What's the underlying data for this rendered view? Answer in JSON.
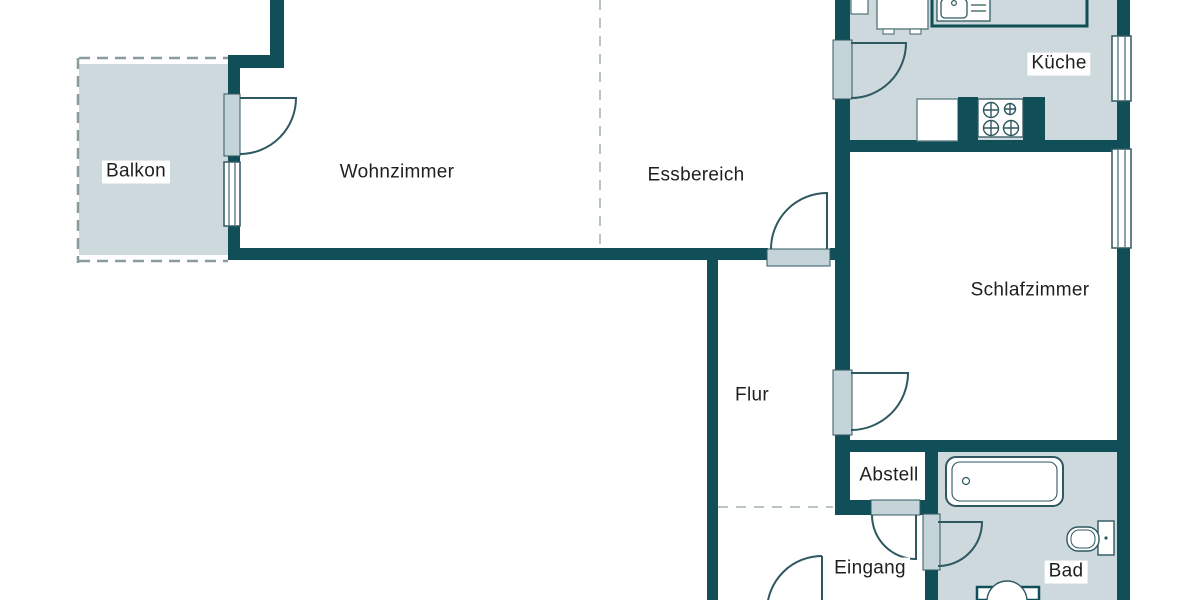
{
  "plan": {
    "type": "floor-plan",
    "language": "de"
  },
  "rooms": {
    "balkon": "Balkon",
    "wohnzimmer": "Wohnzimmer",
    "essbereich": "Essbereich",
    "kueche": "Küche",
    "schlafzimmer": "Schlafzimmer",
    "flur": "Flur",
    "abstell": "Abstell",
    "eingang": "Eingang",
    "bad": "Bad"
  },
  "colors": {
    "wall": "#104e58",
    "floor_fill": "#cdd9dd",
    "door_jamb": "#c4d4d8",
    "dashed_line": "#8a9ba0",
    "divider_dash": "#b8c4c8",
    "label_text": "#1f1f1f"
  },
  "fixtures": [
    "fridge",
    "kitchen-sink",
    "stove",
    "bathtub",
    "toilet",
    "washbasin"
  ]
}
